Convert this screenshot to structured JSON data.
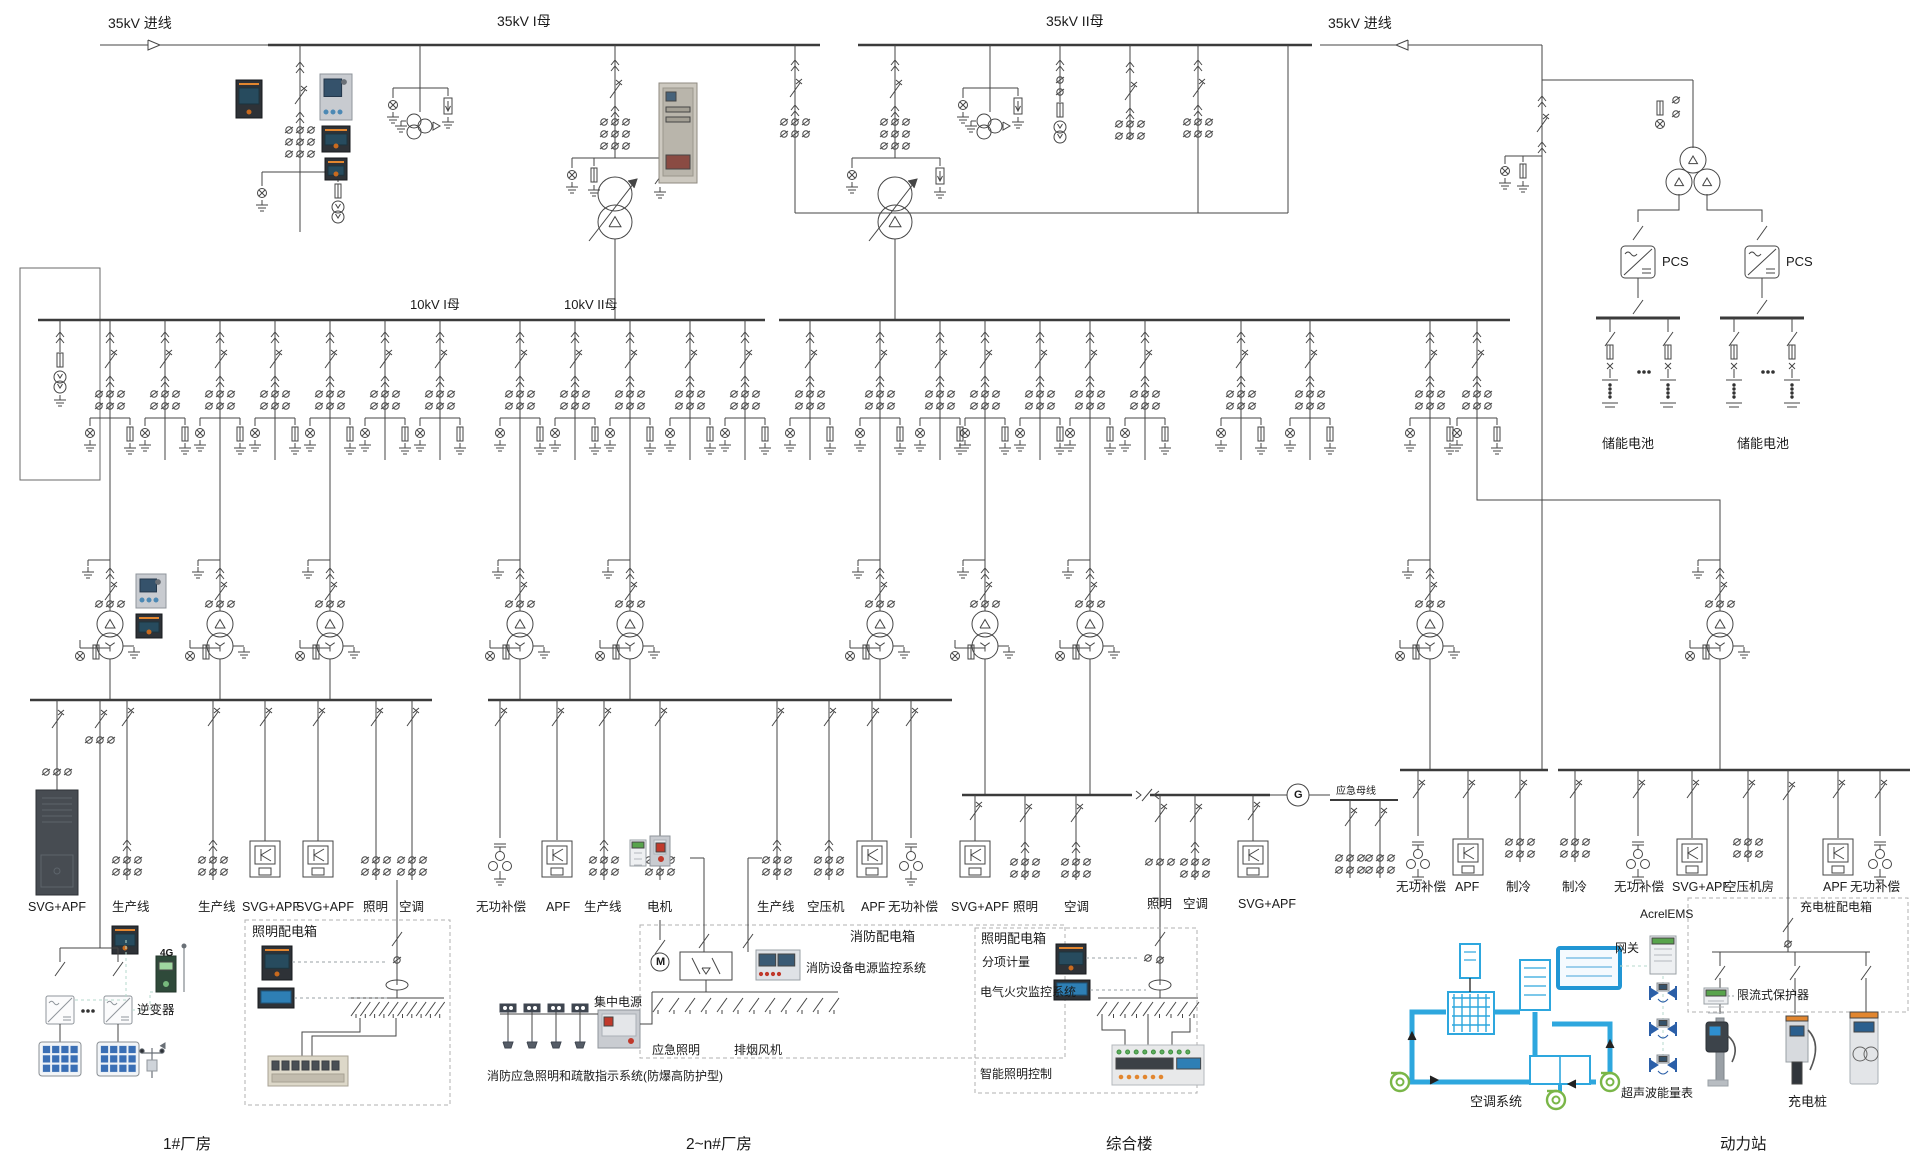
{
  "top": {
    "incoming_left": "35kV 进线",
    "bus_i": "35kV I母",
    "bus_ii": "35kV II母",
    "incoming_right": "35kV 进线"
  },
  "mv": {
    "bus_i": "10kV I母",
    "bus_ii": "10kV II母"
  },
  "storage": {
    "pcs_left": "PCS",
    "pcs_right": "PCS",
    "battery_left": "储能电池",
    "battery_right": "储能电池"
  },
  "plant1": {
    "title": "1#厂房",
    "feeders": [
      "SVG+APF",
      "生产线",
      "生产线",
      "SVG+APF",
      "SVG+APF",
      "照明",
      "空调"
    ],
    "lighting_box": "照明配电箱",
    "g4": "4G",
    "inverter": "逆变器"
  },
  "plant2": {
    "title": "2~n#厂房",
    "feeders": [
      "无功补偿",
      "APF",
      "生产线",
      "电机",
      "生产线",
      "空压机",
      "APF",
      "无功补偿"
    ],
    "motor": "M",
    "fire_box": "消防配电箱",
    "fire_monitor": "消防设备电源监控系统",
    "central_power": "集中电源",
    "emergency_lighting": "应急照明",
    "smoke_fan": "排烟风机",
    "fire_system": "消防应急照明和疏散指示系统(防爆高防护型)"
  },
  "complex_building": {
    "title": "综合楼",
    "feeders": [
      "SVG+APF",
      "照明",
      "空调",
      "照明",
      "空调",
      "SVG+APF"
    ],
    "generator": "G",
    "emergency_bus": "应急母线",
    "lighting_box": "照明配电箱",
    "sub_metering": "分项计量",
    "fire_monitor": "电气火灾监控系统",
    "smart_lighting": "智能照明控制"
  },
  "power_station": {
    "title": "动力站",
    "feeders": [
      "无功补偿",
      "APF",
      "制冷",
      "制冷",
      "无功补偿",
      "SVG+APF",
      "空压机房",
      "APF",
      "无功补偿"
    ],
    "ems": "AcrelEMS",
    "gateway": "网关",
    "charger_box": "充电桩配电箱",
    "current_limiter": "限流式保护器",
    "hvac": "空调系统",
    "ultrasonic_meter": "超声波能量表",
    "charging_pile": "充电桩"
  }
}
